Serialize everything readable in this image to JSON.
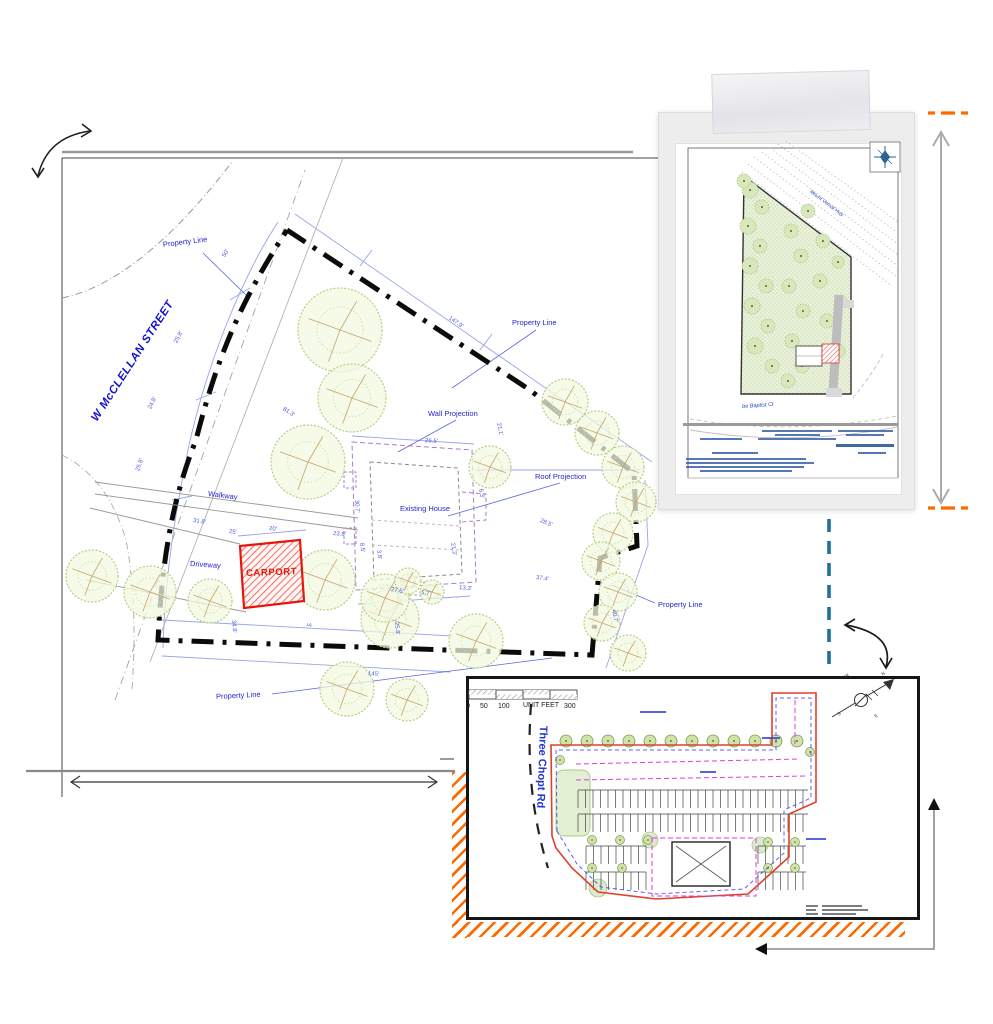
{
  "main_plan": {
    "street_label": "W McCLELLAN STREET",
    "property_line": "Property Line",
    "wall_projection": "Wall Projection",
    "roof_projection": "Roof Projection",
    "existing_house": "Existing House",
    "walkway": "Walkway",
    "driveway": "Driveway",
    "carport": "CARPORT",
    "dimension_labels": [
      {
        "t": "50'",
        "x": 224,
        "y": 254,
        "r": -58
      },
      {
        "t": "25.8'",
        "x": 176,
        "y": 340,
        "r": -62
      },
      {
        "t": "24.8'",
        "x": 150,
        "y": 406,
        "r": -64
      },
      {
        "t": "25.8'",
        "x": 138,
        "y": 468,
        "r": -70
      },
      {
        "t": "81.3'",
        "x": 283,
        "y": 406,
        "r": 33
      },
      {
        "t": "147.9'",
        "x": 449,
        "y": 315,
        "r": 35
      },
      {
        "t": "21.1'",
        "x": 498,
        "y": 420,
        "r": 78
      },
      {
        "t": "26.5'",
        "x": 425,
        "y": 438,
        "r": 4
      },
      {
        "t": "6.3'",
        "x": 480,
        "y": 486,
        "r": 78
      },
      {
        "t": "21.2'",
        "x": 452,
        "y": 540,
        "r": 80
      },
      {
        "t": "28.5'",
        "x": 540,
        "y": 518,
        "r": 22
      },
      {
        "t": "37.4'",
        "x": 536,
        "y": 575,
        "r": 8
      },
      {
        "t": "30.7'",
        "x": 356,
        "y": 497,
        "r": 85
      },
      {
        "t": "8.5'",
        "x": 361,
        "y": 540,
        "r": 82
      },
      {
        "t": "3.8'",
        "x": 378,
        "y": 547,
        "r": 82
      },
      {
        "t": "27.5'",
        "x": 391,
        "y": 587,
        "r": 10
      },
      {
        "t": "5.7'",
        "x": 421,
        "y": 590,
        "r": 10
      },
      {
        "t": "13.3'",
        "x": 459,
        "y": 585,
        "r": 6
      },
      {
        "t": "25.8'",
        "x": 396,
        "y": 619,
        "r": 85
      },
      {
        "t": "31.8'",
        "x": 193,
        "y": 518,
        "r": 8
      },
      {
        "t": "25'",
        "x": 229,
        "y": 529,
        "r": 8
      },
      {
        "t": "20'",
        "x": 269,
        "y": 526,
        "r": 5
      },
      {
        "t": "23.8'",
        "x": 333,
        "y": 531,
        "r": 5
      },
      {
        "t": "34.8'",
        "x": 233,
        "y": 617,
        "r": 85
      },
      {
        "t": "3'",
        "x": 308,
        "y": 620,
        "r": 85
      },
      {
        "t": "40.7'",
        "x": 613,
        "y": 607,
        "r": 78
      },
      {
        "t": "145'",
        "x": 368,
        "y": 671,
        "r": 4
      }
    ]
  },
  "inset_plan": {
    "highway_label": "Mount Vernal Hwy",
    "court_label": "be Baptist Ct"
  },
  "bottom_plan": {
    "road_label": "Three Chopt Rd",
    "scale_bar": {
      "ticks": [
        "0",
        "50",
        "100"
      ],
      "unit": "UNIT FEET",
      "max": "300"
    },
    "compass": {
      "n": "N",
      "s": "S",
      "e": "E",
      "w": "W"
    }
  }
}
